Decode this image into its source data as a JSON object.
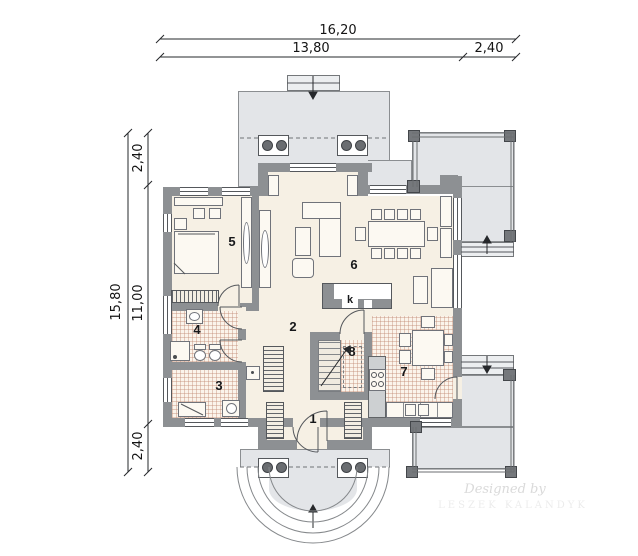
{
  "title": "house-ground-floor-plan",
  "dimensions": {
    "top_total": "16,20",
    "top_main": "13,80",
    "top_side": "2,40",
    "left_total": "15,80",
    "left_top": "2,40",
    "left_main": "11,00",
    "left_bottom": "2,40"
  },
  "rooms": [
    {
      "label": "1"
    },
    {
      "label": "2"
    },
    {
      "label": "3"
    },
    {
      "label": "4"
    },
    {
      "label": "5"
    },
    {
      "label": "6"
    },
    {
      "label": "7"
    },
    {
      "label": "8"
    }
  ],
  "fireplace_label": "k",
  "watermark": {
    "line1": "Designed by",
    "line2": "LESZEK KALANDYK"
  },
  "colors": {
    "wall": "#8d9093",
    "terrace": "#e3e5e8",
    "floor": "#f6f0e4",
    "tile_line": "#bf866f",
    "dimension": "#26282b"
  }
}
